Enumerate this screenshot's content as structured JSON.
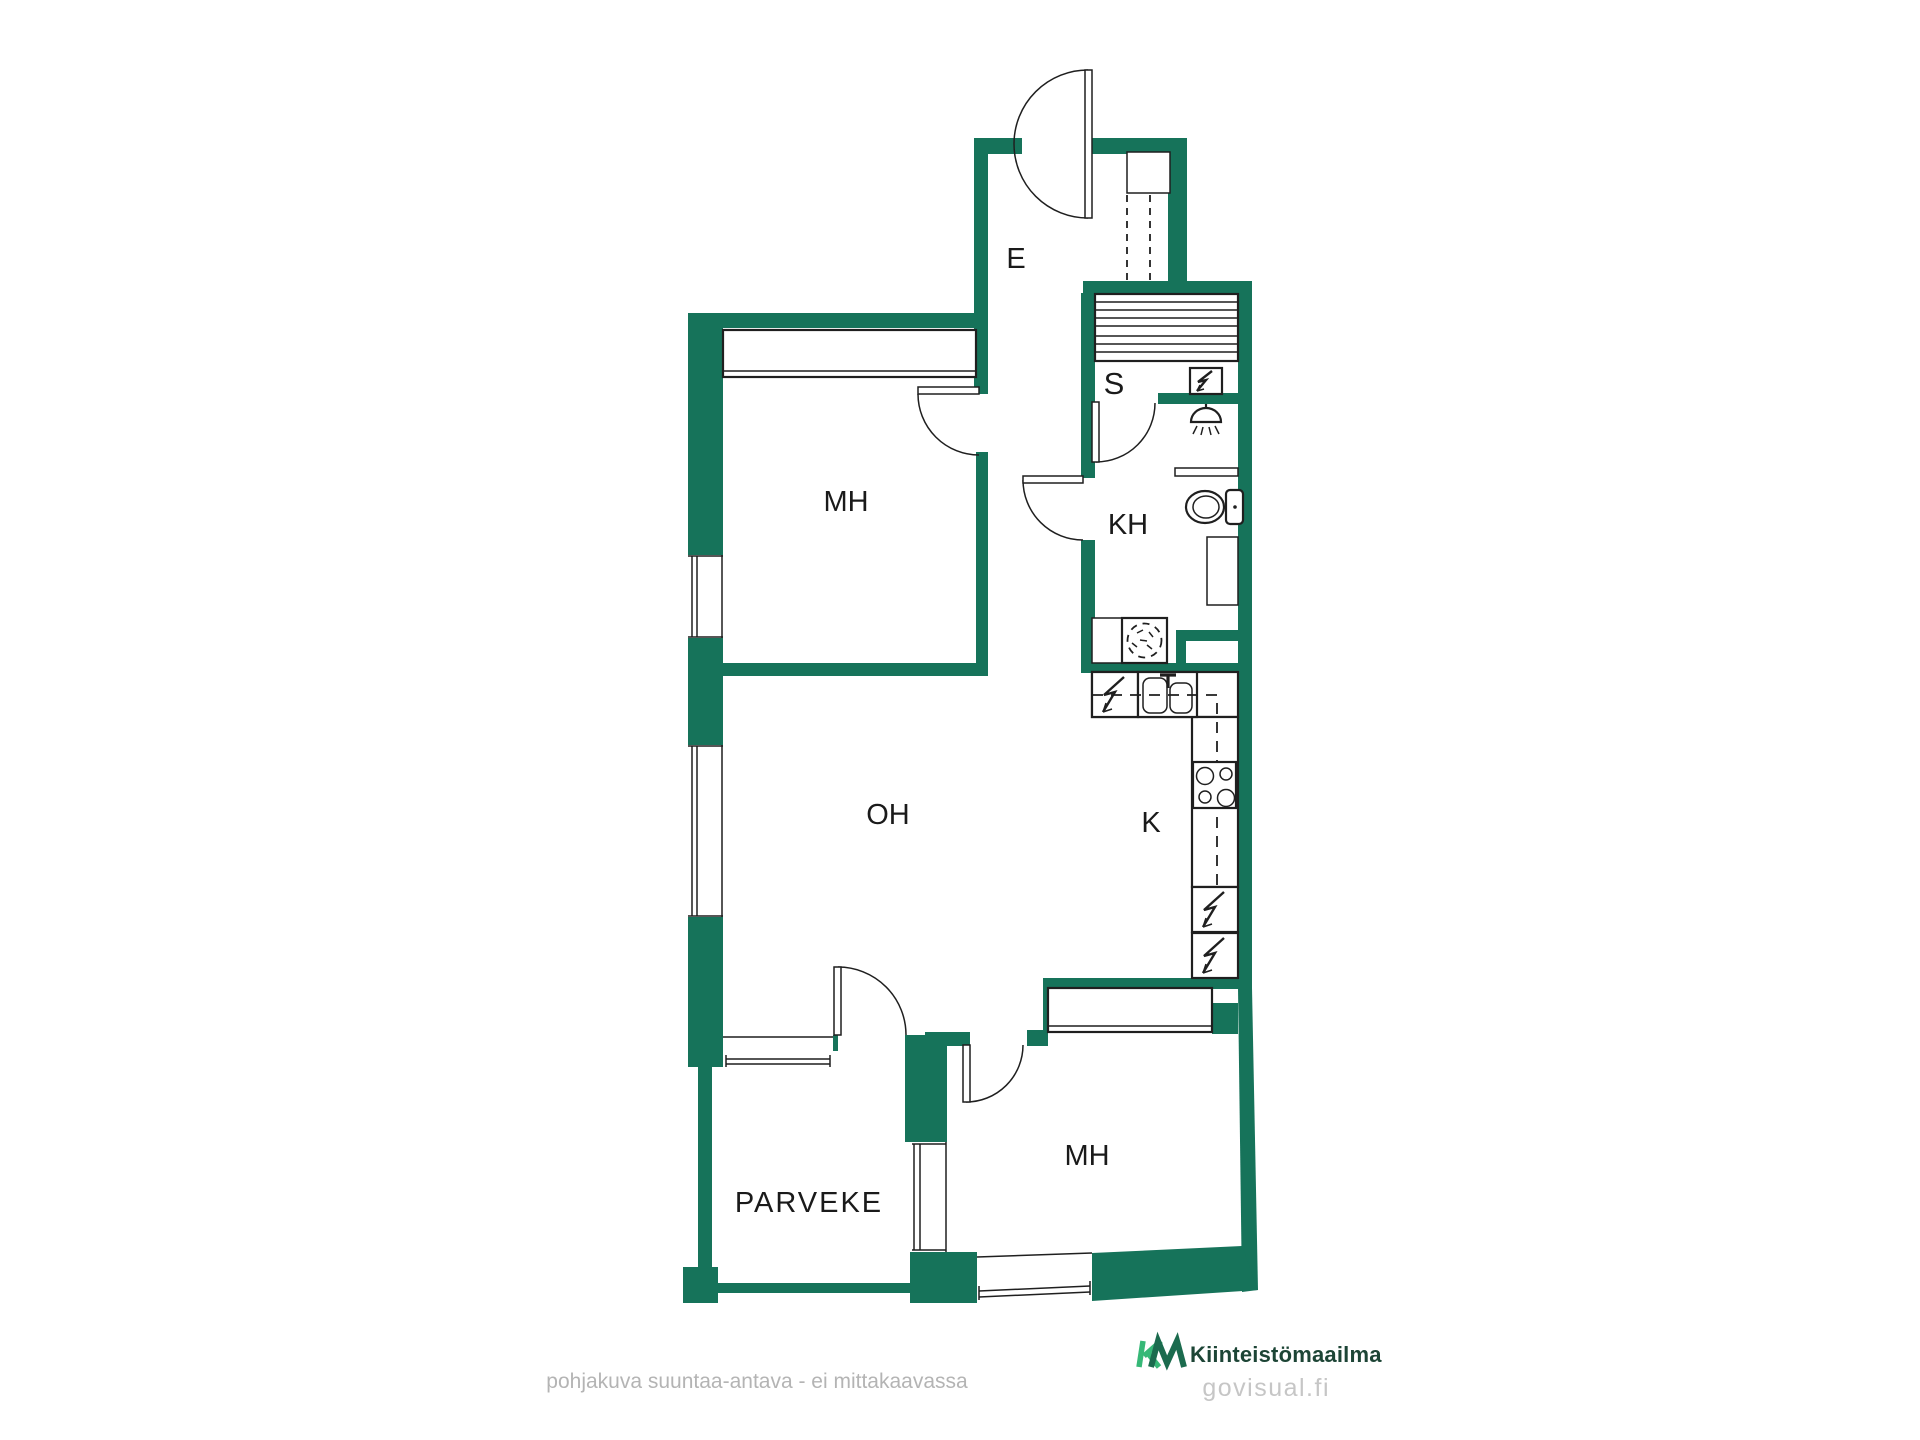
{
  "colors": {
    "wall": "#16735A",
    "label": "#1A1A1A",
    "logo_k": "#36B877",
    "logo_m": "#1B6B4E",
    "logo_text": "#1D4536",
    "footer_text": "#B4B4B4",
    "watermark": "#C6C6C6",
    "background": "#FFFFFF"
  },
  "rooms": {
    "entrance": "E",
    "sauna": "S",
    "bathroom": "KH",
    "bedroom_top": "MH",
    "living_room": "OH",
    "kitchen": "K",
    "bedroom_bottom": "MH",
    "balcony": "PARVEKE"
  },
  "footer": {
    "disclaimer": "pohjakuva suuntaa-antava - ei mittakaavassa",
    "brand": "Kiinteistömaailma",
    "watermark": "govisual.fi"
  }
}
